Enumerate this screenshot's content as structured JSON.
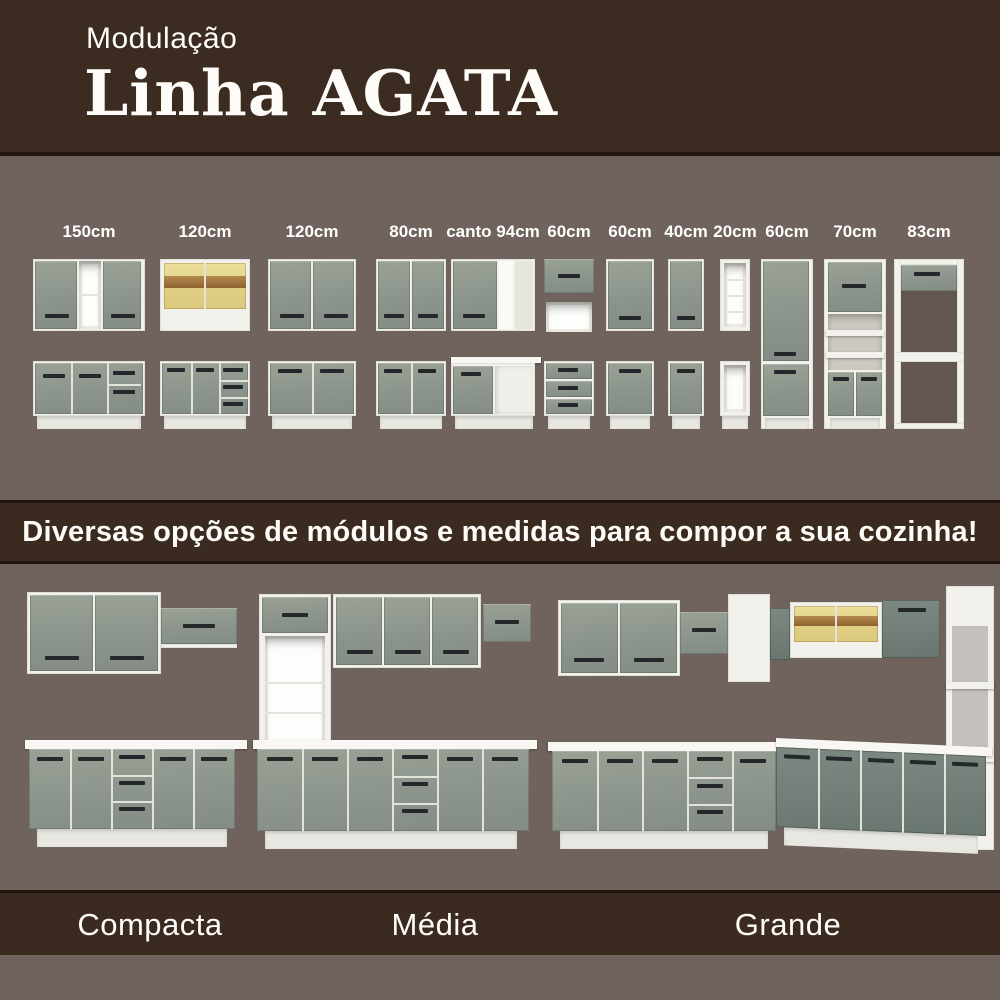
{
  "header": {
    "subtitle": "Modulação",
    "title": "Linha AGATA"
  },
  "modules": [
    {
      "label": "150cm"
    },
    {
      "label": "120cm"
    },
    {
      "label": "120cm"
    },
    {
      "label": "80cm"
    },
    {
      "label": "canto 94cm"
    },
    {
      "label": "60cm"
    },
    {
      "label": "60cm"
    },
    {
      "label": "40cm"
    },
    {
      "label": "20cm"
    },
    {
      "label": "60cm"
    },
    {
      "label": "70cm"
    },
    {
      "label": "83cm"
    }
  ],
  "tagline": "Diversas opções de módulos e medidas para compor a sua cozinha!",
  "kitchens": [
    {
      "label": "Compacta"
    },
    {
      "label": "Média"
    },
    {
      "label": "Grande"
    }
  ],
  "colors": {
    "background_taupe": "#70625c",
    "panel_brown": "#3b2a1f",
    "separator_brown": "#24150e",
    "cabinet_green": "#8d978c",
    "cabinet_dark_green": "#6e7b76",
    "carcass_white": "#f2f1ec",
    "glass_yellow": "#e5d692",
    "wood": "#a07a42",
    "text": "#ffffff"
  }
}
